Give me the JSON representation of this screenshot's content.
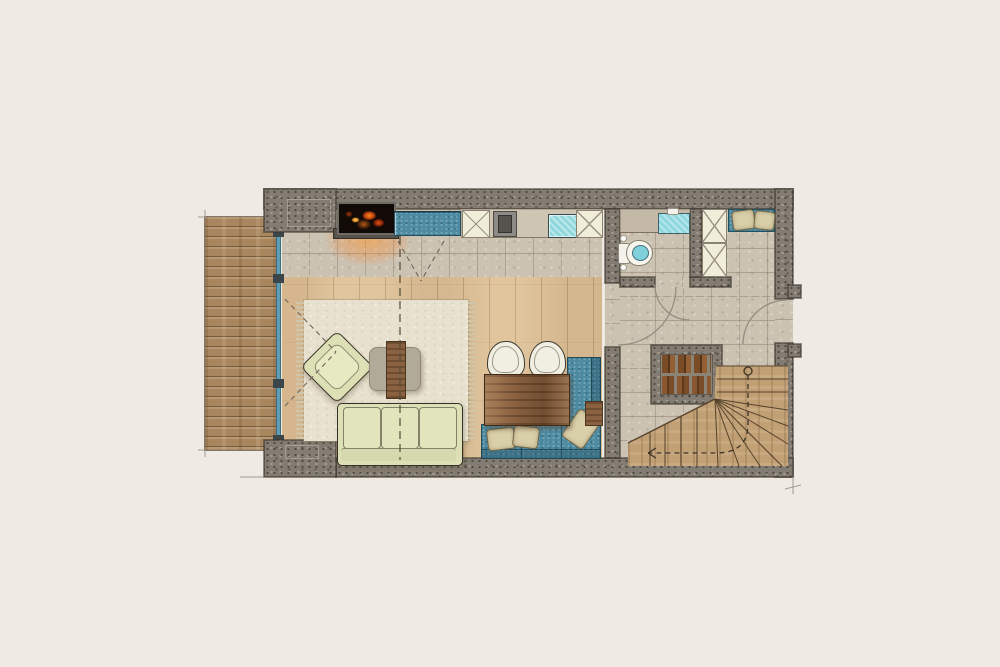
{
  "document": {
    "kind": "architectural floor plan, top-down colored rendering",
    "visible_text": "none",
    "rooms": [
      {
        "id": "terrace",
        "label": "wood deck terrace"
      },
      {
        "id": "living-dining",
        "label": "living and dining room with wood floor"
      },
      {
        "id": "kitchen",
        "label": "kitchen counter run along top wall"
      },
      {
        "id": "bathroom",
        "label": "bathroom with toilet and washbasin"
      },
      {
        "id": "hallway",
        "label": "entry hall with stone tile floor"
      },
      {
        "id": "staircase",
        "label": "winder staircase with firewood niche"
      }
    ],
    "fixtures": [
      "fireplace with ember glow",
      "blue kitchen counter",
      "tall cross-front cabinet x3",
      "built-in appliance",
      "kitchen sink",
      "bathroom washbasin",
      "toilet",
      "entry bench with cushions",
      "glass wall to terrace",
      "area rug with fringe",
      "armchair",
      "coffee table with wood runner",
      "three-seat sofa",
      "dining table",
      "two round-back chairs",
      "L-shaped blue corner bench",
      "three bench pillows",
      "firewood stack",
      "fan-shaped wood stairs",
      "door swing arcs x3",
      "dashed section line",
      "stair walk-line with start circle"
    ]
  },
  "colors": {
    "bg": "#efeae3",
    "wall": "#837c72",
    "stone": "#ccc2b1",
    "wood_floor": "#dcc19b",
    "terrace_wood": "#a8875f",
    "stair_wood": "#c2a075",
    "cabinet_cream": "#f0edd9",
    "bench_blue": "#4d8ba2",
    "sink_cyan": "#8fd8de",
    "sofa_green": "#dde0b5",
    "rug": "#e8e1cf",
    "table_wood": "#8a6241",
    "pillow": "#d9cfa8",
    "fire_orange": "#ff8c1a",
    "glass_teal": "#5d9db3",
    "hearth_gray": "#57524b",
    "line_ink": "#6e655a"
  }
}
